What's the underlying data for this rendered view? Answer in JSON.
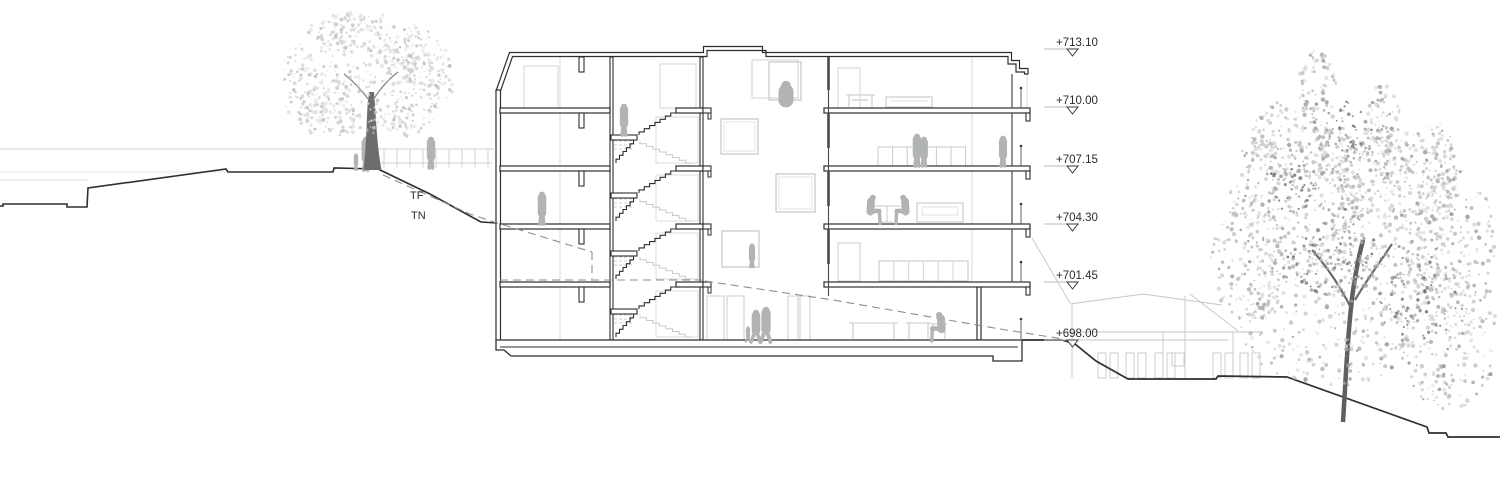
{
  "drawing": {
    "type": "architectural cross-section",
    "annotation_labels": {
      "tf": "TF",
      "tn": "TN"
    },
    "elevation_markers": [
      {
        "label": "+713.10",
        "y": 49
      },
      {
        "label": "+710.00",
        "y": 107
      },
      {
        "label": "+707.15",
        "y": 166
      },
      {
        "label": "+704.30",
        "y": 224
      },
      {
        "label": "+701.45",
        "y": 282
      },
      {
        "label": "+698.00",
        "y": 340
      }
    ],
    "colors": {
      "ink": "#2e2e2e",
      "light_line": "#c9c9c9",
      "figure": "#b1b3b5",
      "dashed_line": "#8f8f8f",
      "background": "#ffffff"
    }
  }
}
